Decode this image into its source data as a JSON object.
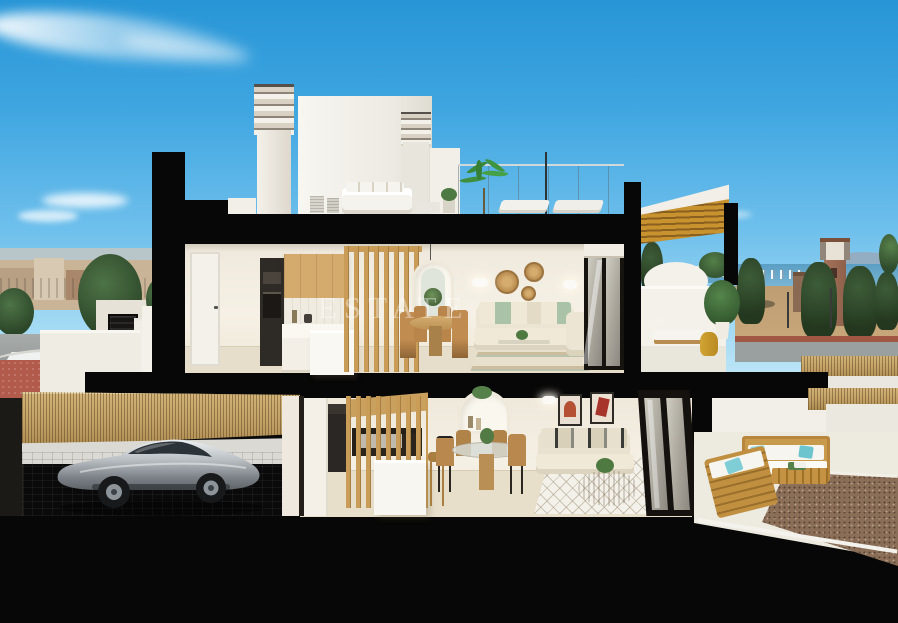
{
  "image": {
    "kind": "3d-architectural-cross-section-render",
    "width_px": 898,
    "height_px": 623,
    "description": "Real-estate marketing render: vertical cross-section of a two-storey white villa at dusk-lit day, furnished interiors, rooftop terrace, garage with silver sports car, sea and town in the background"
  },
  "watermark": {
    "text": "ESTATE"
  },
  "palette": {
    "sky_top": "#2795d6",
    "sky_horizon": "#d3eefa",
    "section_cut_black": "#070707",
    "wall_white": "#f2efe8",
    "interior_wall": "#f3eee3",
    "interior_floor": "#e6decb",
    "wood_slat": "#c99c58",
    "oak_cabinet": "#d4ab6c",
    "canopy_wood": "#c8922f",
    "cane_fence": "#c2a065",
    "garage_floor": "#b7babc",
    "car_silver": "#b9bfc3",
    "sage_pillow": "#a9c2a8",
    "teal_pillow": "#8fd6dc",
    "terracotta_art": "#b55034",
    "sea_blue": "#5a9ec4",
    "sand_field": "#bd9d72",
    "red_pavement": "#b25a4b",
    "brick_tower": "#9b6b50",
    "gravel_brown": "#8a6e57"
  },
  "scene": {
    "sky": {
      "elements": [
        "wispy-cloud-streak",
        "small-cloud",
        "faint-cloud"
      ]
    },
    "background_left": {
      "elements": [
        "distant-hills",
        "town-skyline",
        "street-trees",
        "grey-road",
        "red-pavement"
      ]
    },
    "background_right": {
      "elements": [
        "sea-horizon",
        "distant-mountains",
        "shoreline-town",
        "sand-field",
        "brick-watchtower",
        "pine-trees",
        "low-building",
        "street-lamps",
        "road",
        "cane-fence",
        "boundary-wall",
        "palm-fronds"
      ]
    },
    "roof_level": {
      "elements": [
        "louvered-chimney-left",
        "white-roof-volume",
        "louvered-chimney-right",
        "white-parapet",
        "glass-railing",
        "roof-lounge-set",
        "ac-units",
        "potted-plants",
        "palm-plant",
        "sun-loungers",
        "wood-slat-canopy"
      ]
    },
    "upper_floor": {
      "exterior": [
        "entry-staircase",
        "stair-parapet",
        "louvered-gate"
      ],
      "hallway": [
        "white-interior-door"
      ],
      "kitchen": [
        "oven-column",
        "oak-upper-cabinets",
        "tile-backsplash",
        "base-cabinets",
        "white-island",
        "wood-slat-partition"
      ],
      "dining": [
        "pendant-light",
        "arched-niche",
        "round-wood-table",
        "rattan-chairs"
      ],
      "living": [
        "rattan-wall-plates",
        "wall-sconces",
        "beige-corner-sofa",
        "sage-and-cream-pillows",
        "coffee-table",
        "striped-rug",
        "sliding-glass-door"
      ],
      "terrace": [
        "curved-white-parapet",
        "sun-lounger",
        "yellow-drum-side-table",
        "potted-green-plant"
      ]
    },
    "lower_floor": {
      "garage": [
        "dark-side-wall",
        "cane-fence-wall",
        "paver-floor",
        "silver-sports-car"
      ],
      "kitchen": [
        "appliance-column",
        "stair-slat-screen",
        "white-island",
        "rattan-barstool",
        "arched-shelf-niche"
      ],
      "dining": [
        "glass-round-table",
        "wood-chairs",
        "wall-sconce"
      ],
      "living": [
        "two-framed-artworks",
        "beige-sofa",
        "patterned-pillows",
        "rattan-coffee-table",
        "lattice-rug",
        "plant-side-table",
        "sliding-glass-door"
      ],
      "patio": [
        "white-back-wall",
        "cane-fence-strip",
        "patio-floor",
        "wood-outdoor-sofa-back",
        "wood-outdoor-sofa-front",
        "teal-outdoor-pillows",
        "wood-coffee-table",
        "white-curb",
        "gravel-bed"
      ]
    },
    "structure": [
      "left-cut-wall",
      "roof-slab",
      "mid-floor-slab",
      "terrace-cut-column",
      "patio-cut-column",
      "canopy-cut-column",
      "foundation-slab"
    ]
  }
}
